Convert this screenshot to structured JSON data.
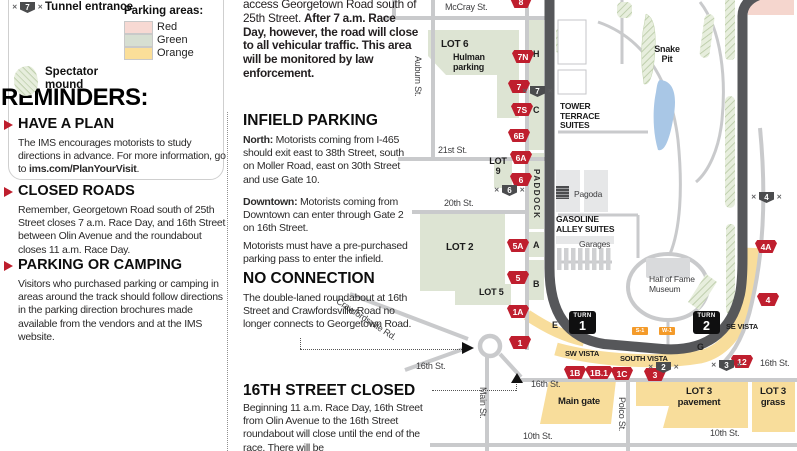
{
  "colors": {
    "gate_red": "#bf1e2e",
    "track_gray": "#56575a",
    "lot_yellow": "#f8dd9b",
    "lot_green": "#dde4d3",
    "area_pink": "#f5d6ce",
    "badge_black": "#0f0f10",
    "mini_orange": "#f49b2a",
    "pond_blue": "#a9c7e6"
  },
  "legend": {
    "tunnel_badge": "7",
    "tunnel_label": "Tunnel entrance",
    "mound_label": "Spectator mound",
    "parking_title": "Parking areas:",
    "areas": [
      {
        "label": "Red",
        "color": "#f7d9d3"
      },
      {
        "label": "Green",
        "color": "#d7dfd2"
      },
      {
        "label": "Orange",
        "color": "#fbdf99"
      }
    ]
  },
  "reminders": {
    "title": "REMINDERS:",
    "have_a_plan": {
      "heading": "HAVE A PLAN",
      "body": "The IMS encourages motorists to study directions in advance. For more information, go to ",
      "link": "ims.com/PlanYourVisit",
      "suffix": "."
    },
    "closed_roads": {
      "heading": "CLOSED ROADS",
      "body": "Remember, Georgetown Road south of 25th Street closes 7 a.m. Race Day, and 16th Street between Olin Avenue and the roundabout closes 11 a.m. Race Day."
    },
    "parking_camping": {
      "heading": "PARKING OR CAMPING",
      "body": "Visitors who purchased parking or camping in areas around the track should follow directions in the parking direction brochures made available from the vendors and at the IMS website."
    }
  },
  "notes": {
    "intro": {
      "normal": "access Georgetown Road south of 25th Street.  ",
      "bold": "After 7 a.m. Race Day, however, the road will close to all vehicular traffic. This area will be monitored by law enforcement."
    },
    "infield": {
      "heading": "INFIELD PARKING",
      "north_label": "North:",
      "north_body": " Motorists coming from I-465 should exit east to 38th Street, south on Moller Road, east on 30th Street and use Gate 10.",
      "downtown_label": "Downtown:",
      "downtown_body": " Motorists coming from Downtown can enter through Gate 2 on 16th Street.",
      "pass_note": "Motorists must have a pre-purchased parking pass to enter the infield."
    },
    "no_connection": {
      "heading": "NO CONNECTION",
      "body": "The double-laned roundabout at 16th Street and Crawfordsville Road no longer connects to Georgetown Road."
    },
    "street_closed": {
      "heading": "16TH STREET CLOSED",
      "body": "Beginning 11 a.m. Race Day, 16th Street from Olin Avenue to the 16th Street roundabout will close until the end of the race. There will be"
    }
  },
  "map": {
    "streets": [
      "McCray St.",
      "Auburn St.",
      "21st St.",
      "20th St.",
      "16th St.",
      "16th St.",
      "16th St.",
      "10th St.",
      "10th St.",
      "Main St.",
      "Polco St.",
      "Crawfordsville Rd."
    ],
    "areas": {
      "lot6": "LOT 6",
      "hulman_1": "Hulman",
      "hulman_2": "parking",
      "lot9_1": "LOT",
      "lot9_2": "9",
      "lot2": "LOT 2",
      "lot5": "LOT 5",
      "snake_1": "Snake",
      "snake_2": "Pit",
      "tower_1": "TOWER",
      "tower_2": "TERRACE",
      "tower_3": "SUITES",
      "gas_1": "GASOLINE",
      "gas_2": "ALLEY SUITES",
      "garages": "Garages",
      "pagoda": "Pagoda",
      "museum_1": "Hall of Fame",
      "museum_2": "Museum",
      "sw_vista": "SW VISTA",
      "south_vista": "SOUTH VISTA",
      "se_vista": "SE VISTA",
      "main_gate": "Main gate",
      "lot3p_1": "LOT 3",
      "lot3p_2": "pavement",
      "lot3g_1": "LOT 3",
      "lot3g_2": "grass",
      "paddock": "PADDOCK"
    },
    "stands": [
      "H",
      "C",
      "A",
      "B",
      "E",
      "G"
    ],
    "gates": [
      "8",
      "7N",
      "7",
      "7S",
      "6B",
      "6A",
      "6",
      "5A",
      "5",
      "1A",
      "1",
      "1B",
      "1B.1",
      "1C",
      "3",
      "12",
      "4",
      "4A"
    ],
    "tunnels": [
      "7",
      "6",
      "2",
      "3",
      "4"
    ],
    "turns": [
      {
        "line1": "TURN",
        "line2": "1"
      },
      {
        "line1": "TURN",
        "line2": "2"
      }
    ],
    "mini_badges": [
      "S-1",
      "W-1"
    ]
  }
}
